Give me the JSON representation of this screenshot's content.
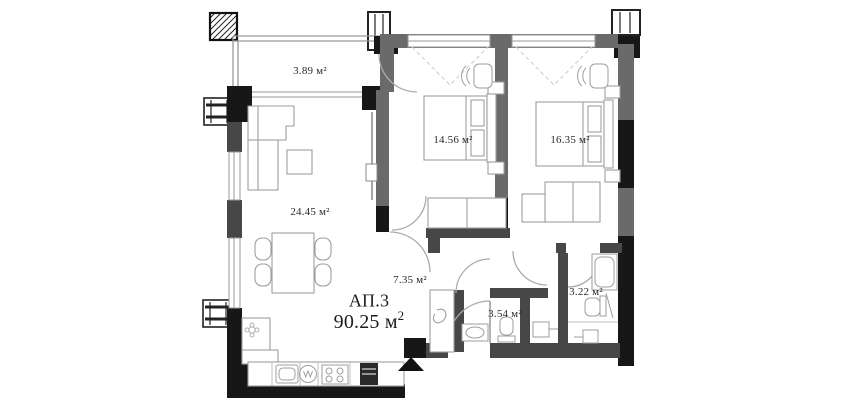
{
  "apartment": {
    "id": "АП.3",
    "total_area_main": "90.25 м",
    "total_area_sup": "2"
  },
  "rooms": {
    "terrace": {
      "area": "3.89 м²"
    },
    "bedroom1": {
      "area": "14.56 м²"
    },
    "bedroom2": {
      "area": "16.35 м²"
    },
    "living": {
      "area": "24.45 м²"
    },
    "hallway": {
      "area": "7.35 м²"
    },
    "bathroom": {
      "area": "3.54 м²"
    },
    "wc": {
      "area": "3.22 м²"
    }
  },
  "colors": {
    "wall_black": "#171717",
    "wall_dark": "#474747",
    "wall_gray": "#6a6a6a",
    "furniture_line": "#9e9e9e",
    "background": "#ffffff"
  }
}
